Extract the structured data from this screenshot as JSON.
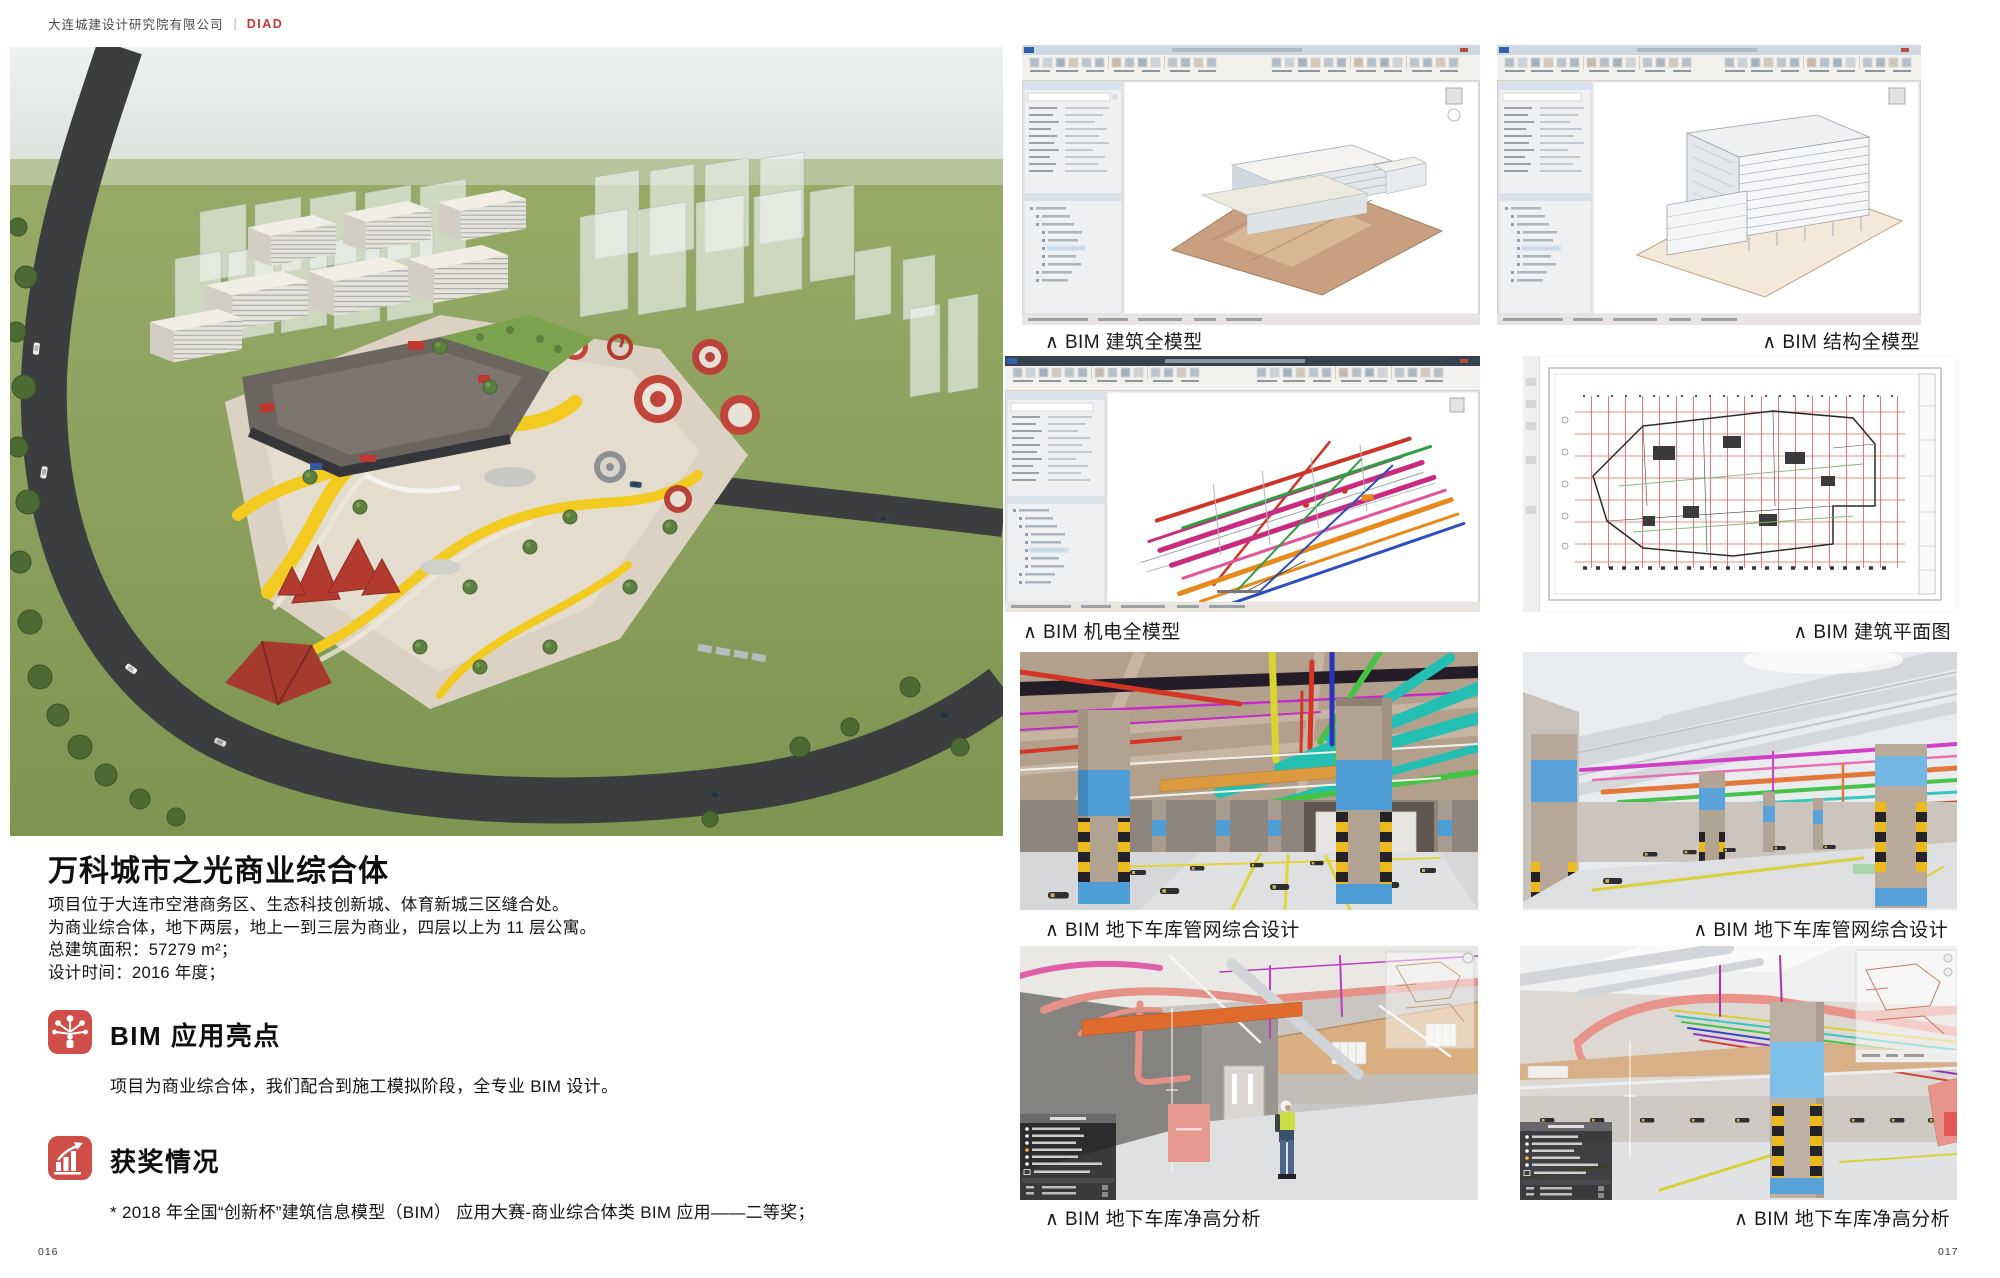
{
  "header": {
    "company": "大连城建设计研究院有限公司",
    "separator": "|",
    "brand": "DIAD"
  },
  "colors": {
    "accent_red": "#cb4a43",
    "caption_text": "#1a1a1a",
    "body_text": "#131313"
  },
  "left_page": {
    "page_number": "016",
    "project_title": "万科城市之光商业综合体",
    "description_lines": [
      "项目位于大连市空港商务区、生态科技创新城、体育新城三区缝合处。",
      "为商业综合体，地下两层，地上一到三层为商业，四层以上为 11 层公寓。",
      "总建筑面积：57279 m²；",
      "设计时间：2016 年度；"
    ],
    "sections": [
      {
        "icon": "bim-network-icon",
        "title": "BIM 应用亮点",
        "body": "项目为商业综合体，我们配合到施工模拟阶段，全专业 BIM 设计。"
      },
      {
        "icon": "award-trend-icon",
        "title": "获奖情况",
        "body": "* 2018 年全国“创新杯”建筑信息模型（BIM） 应用大赛-商业综合体类 BIM 应用——二等奖；"
      }
    ]
  },
  "right_page": {
    "page_number": "017",
    "figures": [
      {
        "id": "bim-architecture-model",
        "caption": "∧ BIM 建筑全模型"
      },
      {
        "id": "bim-structure-model",
        "caption": "∧ BIM 结构全模型"
      },
      {
        "id": "bim-mep-model",
        "caption": "∧ BIM 机电全模型"
      },
      {
        "id": "bim-floor-plan",
        "caption": "∧ BIM 建筑平面图"
      },
      {
        "id": "garage-piping-left",
        "caption": "∧ BIM 地下车库管网综合设计"
      },
      {
        "id": "garage-piping-right",
        "caption": "∧ BIM 地下车库管网综合设计"
      },
      {
        "id": "garage-clearance-left",
        "caption": "∧ BIM 地下车库净高分析"
      },
      {
        "id": "garage-clearance-right",
        "caption": "∧ BIM 地下车库净高分析"
      }
    ]
  }
}
